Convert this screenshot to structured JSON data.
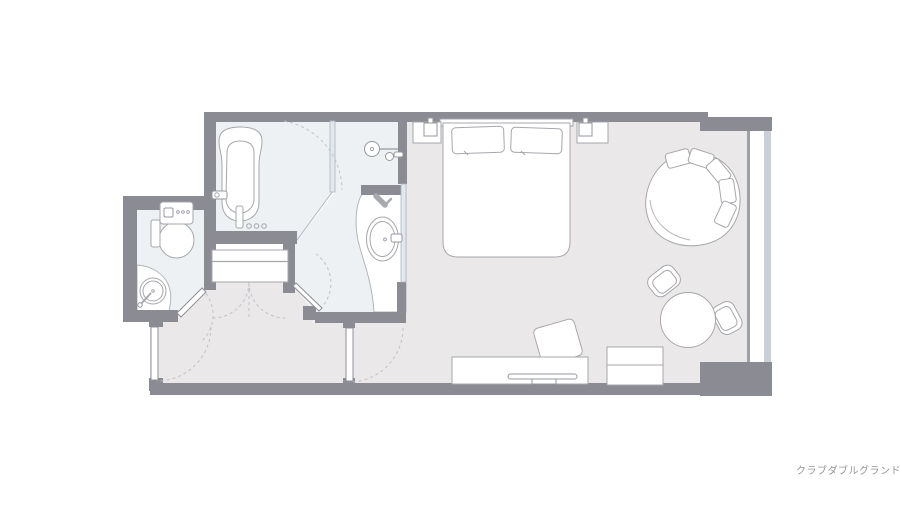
{
  "caption": {
    "label": "クラブダブルグランド"
  },
  "colors": {
    "background": "#ffffff",
    "wall": "#8a8b93",
    "room_floor": "#ebe8e9",
    "wet_floor": "#eef1f3",
    "furniture_stroke": "#a6a7ad",
    "light_stroke": "#b4b5bb",
    "arc_stroke": "#c0c1c7",
    "glass_fill": "#e2e8ee",
    "glass_stroke": "#a9b6c0",
    "window_band": "#cad0d7",
    "caption_text": "#95969a"
  },
  "fixtures": [
    "bathtub",
    "shower-head",
    "hand-shower",
    "hair-dryer",
    "wash-basin",
    "vanity-counter",
    "toilet",
    "corner-hand-basin",
    "closet-shelf",
    "double-bed",
    "pillow",
    "nightstand",
    "table-lamp",
    "round-lounge-chair",
    "round-table",
    "side-chair",
    "desk",
    "tv",
    "desk-chair",
    "luggage-cabinet",
    "entry-door",
    "inner-door",
    "toilet-door",
    "washroom-door",
    "glass-partition",
    "window"
  ]
}
